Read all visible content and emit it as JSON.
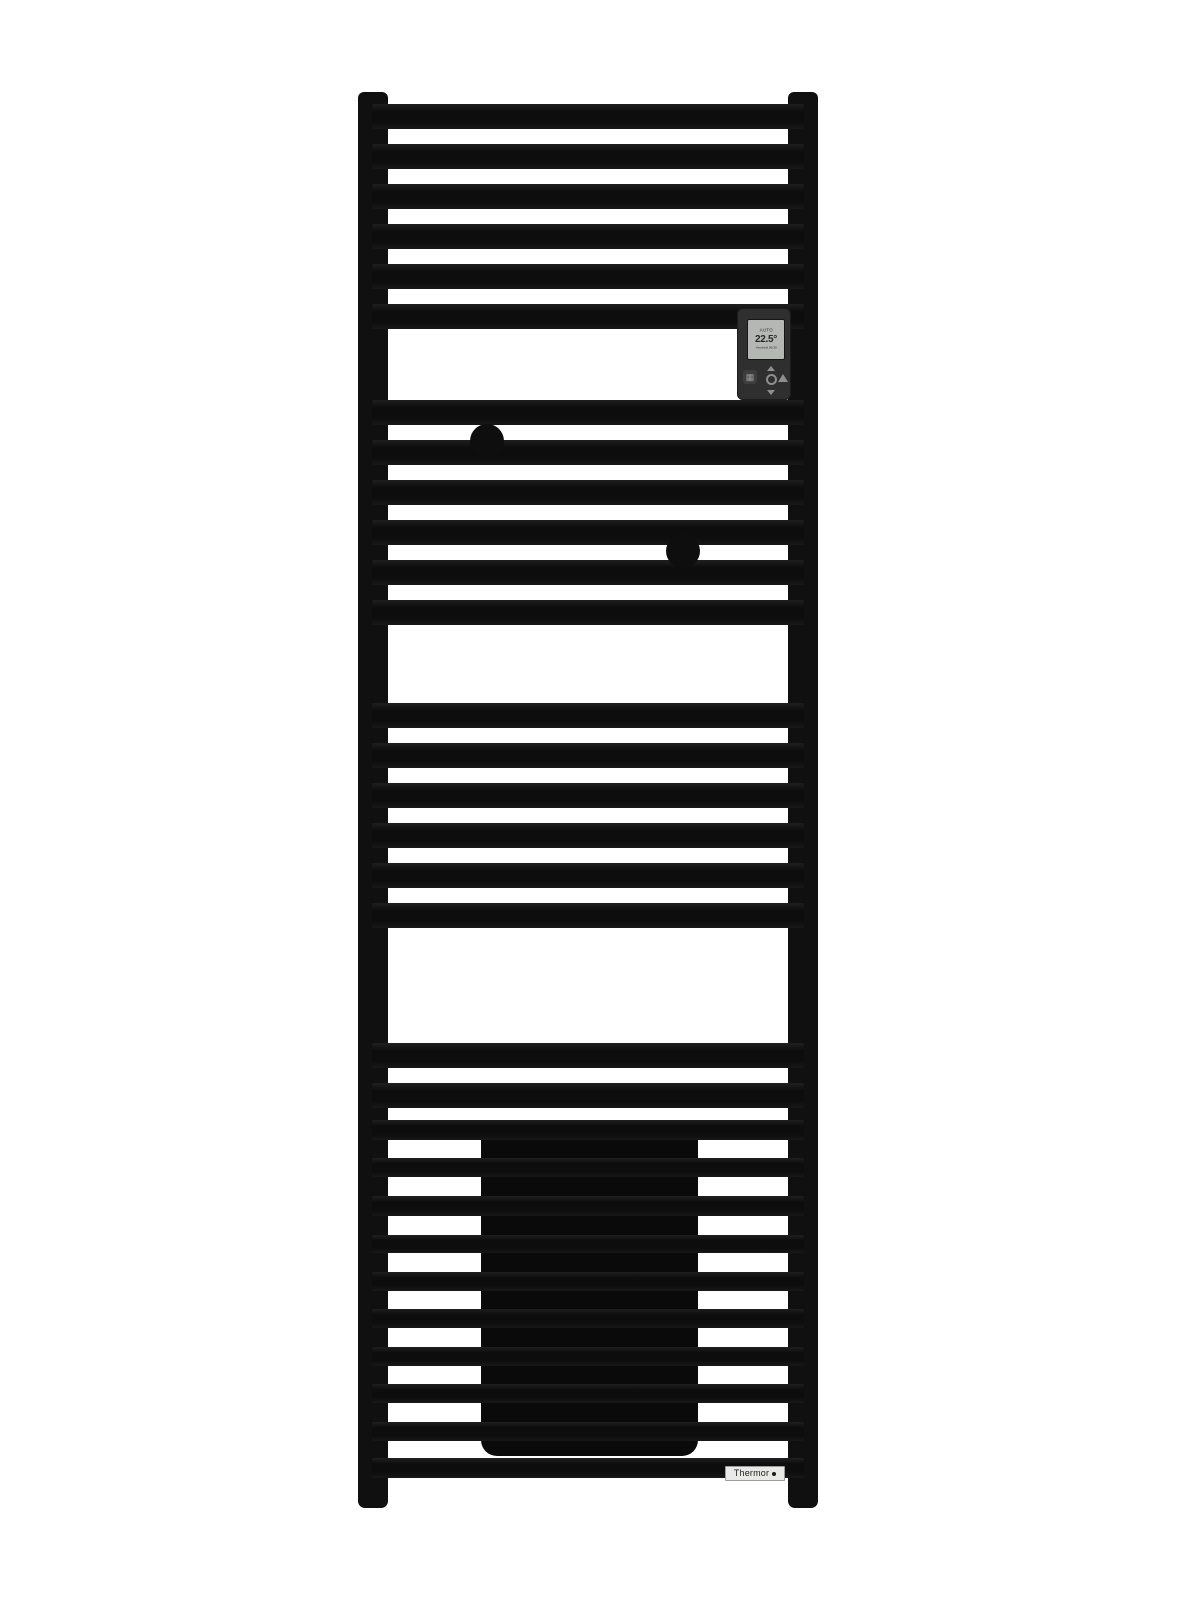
{
  "product": {
    "brand": "Thermor",
    "kind": "black ladder towel-rail radiator with electronic control"
  },
  "colors": {
    "background": "#ffffff",
    "radiator_black": "#101010",
    "heat_panel_black": "#0a0a0a",
    "control_body_gray": "#2f2f2f",
    "screen_gray": "#b5b7b4",
    "label_background": "#e9e9e7"
  },
  "controller": {
    "screen": {
      "mode": "AUTO",
      "temperature": "22.5°",
      "status_line": "Vendredi 06:30"
    },
    "icons": [
      "radiator-icon",
      "chevron-up-icon",
      "ok-ring-icon",
      "chevron-down-icon",
      "boost-icon"
    ]
  },
  "brand_label": {
    "text": "Thermor",
    "dot": "logo-dot"
  },
  "radiator": {
    "bar_left": 372,
    "bar_width": 432,
    "sections": [
      {
        "name": "top-group",
        "bar_height": 25,
        "tops": [
          104,
          144,
          184,
          224,
          264,
          304
        ]
      },
      {
        "name": "second-group",
        "bar_height": 25,
        "tops": [
          400,
          440,
          480,
          520,
          560,
          600
        ]
      },
      {
        "name": "third-group",
        "bar_height": 25,
        "tops": [
          703,
          743,
          783,
          823,
          863,
          903
        ]
      },
      {
        "name": "fourth-group",
        "bar_height": 25,
        "tops": [
          1043,
          1083
        ]
      },
      {
        "name": "bottom-group",
        "tops": [
          1120,
          1158,
          1196,
          1235,
          1272,
          1309,
          1347,
          1384,
          1422,
          1458
        ],
        "heights": [
          20,
          19,
          20,
          18,
          19,
          19,
          19,
          19,
          19,
          20
        ]
      }
    ]
  }
}
